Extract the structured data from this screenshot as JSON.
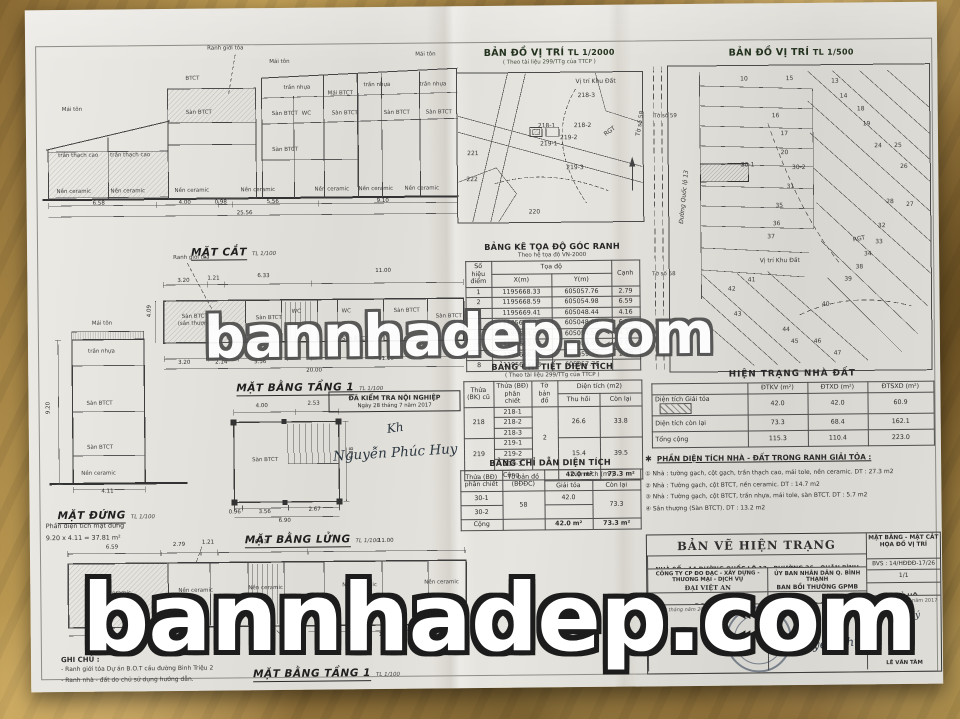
{
  "watermarks": {
    "center": "bannhadep.com",
    "bottom": "bannhadep.com"
  },
  "drawings": {
    "mat_cat": {
      "title": "MẶT CẮT",
      "scale": "TL 1/100",
      "ranh": "Ranh giới tỏa",
      "labels": [
        {
          "t": "Mái tôn",
          "px": 230,
          "py": 12
        },
        {
          "t": "Mái tôn",
          "px": 376,
          "py": 6
        },
        {
          "t": "Mái tôn",
          "px": 22,
          "py": 58
        },
        {
          "t": "BTCT",
          "px": 146,
          "py": 28
        },
        {
          "t": "trần nhựa",
          "px": 244,
          "py": 38
        },
        {
          "t": "trần nhựa",
          "px": 324,
          "py": 36
        },
        {
          "t": "trần nhựa",
          "px": 380,
          "py": 36
        },
        {
          "t": "Sàn BTCT",
          "px": 146,
          "py": 62
        },
        {
          "t": "Sàn BTCT",
          "px": 232,
          "py": 64
        },
        {
          "t": "WC",
          "px": 262,
          "py": 64
        },
        {
          "t": "Sàn BTCT",
          "px": 292,
          "py": 64
        },
        {
          "t": "Sàn BTCT",
          "px": 344,
          "py": 64
        },
        {
          "t": "Sàn BTCT",
          "px": 386,
          "py": 64
        },
        {
          "t": "Mái BTCT",
          "px": 288,
          "py": 44
        },
        {
          "t": "Sàn BTCT",
          "px": 232,
          "py": 100
        },
        {
          "t": "trần thạch cao",
          "px": 18,
          "py": 104
        },
        {
          "t": "trần thạch cao",
          "px": 70,
          "py": 104
        },
        {
          "t": "Nền ceramic",
          "px": 16,
          "py": 140
        },
        {
          "t": "Nền ceramic",
          "px": 70,
          "py": 140
        },
        {
          "t": "Nền ceramic",
          "px": 134,
          "py": 140
        },
        {
          "t": "Nền ceramic",
          "px": 200,
          "py": 140
        },
        {
          "t": "Nền ceramic",
          "px": 274,
          "py": 140
        },
        {
          "t": "Nền ceramic",
          "px": 318,
          "py": 140
        },
        {
          "t": "Nền ceramic",
          "px": 364,
          "py": 140
        }
      ],
      "dims": [
        {
          "t": "6.58",
          "px": 52,
          "py": 152
        },
        {
          "t": "4.00",
          "px": 138,
          "py": 152
        },
        {
          "t": "0.98",
          "px": 174,
          "py": 152
        },
        {
          "t": "5.56",
          "px": 226,
          "py": 152
        },
        {
          "t": "9.10",
          "px": 336,
          "py": 152
        },
        {
          "t": "25.56",
          "px": 196,
          "py": 163
        }
      ]
    },
    "mat_bang_mid": {
      "title": "MẶT BẰNG TẦNG 1",
      "scale": "TL 1/100",
      "ranh": "Ranh giới tỏa",
      "labels": [
        {
          "t": "Sàn BTCT",
          "px": 96,
          "py": 60
        },
        {
          "t": "(sân thượng)",
          "px": 92,
          "py": 67
        },
        {
          "t": "Sàn BTCT",
          "px": 170,
          "py": 62
        },
        {
          "t": "WC",
          "px": 206,
          "py": 56
        },
        {
          "t": "WC",
          "px": 256,
          "py": 56
        },
        {
          "t": "Sàn BTCT",
          "px": 308,
          "py": 56
        },
        {
          "t": "Sàn BTCT",
          "px": 350,
          "py": 62
        },
        {
          "t": "Sàn BTCT",
          "px": 256,
          "py": 84
        }
      ],
      "dims": [
        {
          "t": "3.20",
          "px": 92,
          "py": 24
        },
        {
          "t": "1.21",
          "px": 122,
          "py": 22
        },
        {
          "t": "6.33",
          "px": 172,
          "py": 20
        },
        {
          "t": "11.00",
          "px": 290,
          "py": 16
        },
        {
          "t": "4.09",
          "px": 62,
          "py": 62,
          "r": -90
        },
        {
          "t": "3.20",
          "px": 92,
          "py": 106
        },
        {
          "t": "2.14",
          "px": 129,
          "py": 106
        },
        {
          "t": "3.56",
          "px": 168,
          "py": 106
        },
        {
          "t": "11.10",
          "px": 292,
          "py": 104
        },
        {
          "t": "20.00",
          "px": 220,
          "py": 115
        }
      ]
    },
    "mat_dung": {
      "title": "MẶT ĐỨNG",
      "scale": "TL 1/100",
      "caption1": "Phần diện tích mặt đứng",
      "caption2": "9.20 x 4.11 = 37.81 m²",
      "labels": [
        {
          "t": "Mái tôn",
          "px": 50,
          "py": 0
        },
        {
          "t": "trần nhựa",
          "px": 46,
          "py": 28
        },
        {
          "t": "Sàn BTCT",
          "px": 44,
          "py": 80
        },
        {
          "t": "Sàn BTCT",
          "px": 44,
          "py": 124
        },
        {
          "t": "Nền ceramic",
          "px": 38,
          "py": 150
        }
      ],
      "dims": [
        {
          "t": "9.20",
          "px": 4,
          "py": 92,
          "r": -90
        },
        {
          "t": "4.11",
          "px": 58,
          "py": 168
        }
      ]
    },
    "mat_bang_lung": {
      "title": "MẶT BẰNG LỬNG",
      "scale": "TL 1/100",
      "labels": [
        {
          "t": "Sàn BTCT",
          "px": 28,
          "py": 60
        }
      ],
      "dims": [
        {
          "t": "4.00",
          "px": 32,
          "py": 6
        },
        {
          "t": "2.53",
          "px": 84,
          "py": 4
        },
        {
          "t": "4.38",
          "px": 126,
          "py": 62,
          "r": -90
        },
        {
          "t": "0.96",
          "px": 4,
          "py": 112
        },
        {
          "t": "3.56",
          "px": 34,
          "py": 112
        },
        {
          "t": "2.67",
          "px": 84,
          "py": 110
        },
        {
          "t": "6.90",
          "px": 54,
          "py": 121
        }
      ]
    },
    "mat_bang_bot": {
      "title": "MẶT BẰNG TẦNG 1",
      "scale": "TL 1/100",
      "labels": [
        {
          "t": "Nền ceramic",
          "px": 34,
          "py": 50
        },
        {
          "t": "Nền ceramic",
          "px": 116,
          "py": 48
        },
        {
          "t": "Nền ceramic",
          "px": 186,
          "py": 46
        },
        {
          "t": "Nền ceramic",
          "px": 280,
          "py": 44
        },
        {
          "t": "Nền ceramic",
          "px": 362,
          "py": 42
        }
      ],
      "dims": [
        {
          "t": "6.59",
          "px": 44,
          "py": 4
        },
        {
          "t": "2.79",
          "px": 111,
          "py": 2
        },
        {
          "t": "1.21",
          "px": 140,
          "py": 0
        },
        {
          "t": "6.33",
          "px": 193,
          "py": 0
        },
        {
          "t": "11.00",
          "px": 316,
          "py": 0
        },
        {
          "t": "6.58",
          "px": 44,
          "py": 96
        },
        {
          "t": "11.10",
          "px": 316,
          "py": 94
        }
      ]
    }
  },
  "stamp_check": {
    "line1": "ĐÃ KIỂM TRA NỘI NGHIỆP",
    "line2": "Ngày 28 tháng 7 năm 2017",
    "sign": "Nguyễn Phúc Huy",
    "initial": "Kh"
  },
  "maps": {
    "m2000": {
      "title": "BẢN ĐỒ VỊ TRÍ",
      "scale": "TL 1/2000",
      "subtitle": "( Theo tài liệu 299/TTg của TTCP )",
      "parcels": [
        {
          "t": "Vị trí Khu Đất",
          "px": 120,
          "py": 8
        },
        {
          "t": "218-3",
          "px": 122,
          "py": 22
        },
        {
          "t": "218-1",
          "px": 82,
          "py": 52
        },
        {
          "t": "218-2",
          "px": 118,
          "py": 52
        },
        {
          "t": "219-1",
          "px": 84,
          "py": 70
        },
        {
          "t": "219-2",
          "px": 104,
          "py": 64
        },
        {
          "t": "219-3",
          "px": 110,
          "py": 94
        },
        {
          "t": "220",
          "px": 72,
          "py": 138
        },
        {
          "t": "221",
          "px": 11,
          "py": 79
        },
        {
          "t": "222",
          "px": 10,
          "py": 105
        },
        {
          "t": "RGT",
          "px": 148,
          "py": 58,
          "r": -35
        },
        {
          "t": "Tờ số 58",
          "px": 172,
          "py": 50,
          "r": -80
        }
      ]
    },
    "m500": {
      "title": "BẢN ĐỒ VỊ TRÍ",
      "scale": "TL 1/500",
      "road": "Đường Quốc lộ 13",
      "toso59": "Tờ số 59",
      "toso58": "Tờ số 58",
      "parcels": [
        {
          "t": "10",
          "px": 34,
          "py": 5
        },
        {
          "t": "15",
          "px": 50,
          "py": 5
        },
        {
          "t": "13",
          "px": 66,
          "py": 6
        },
        {
          "t": "14",
          "px": 69,
          "py": 11
        },
        {
          "t": "18",
          "px": 75,
          "py": 15
        },
        {
          "t": "16",
          "px": 45,
          "py": 17
        },
        {
          "t": "17",
          "px": 48,
          "py": 23
        },
        {
          "t": "19",
          "px": 77,
          "py": 20
        },
        {
          "t": "20",
          "px": 48,
          "py": 29
        },
        {
          "t": "24",
          "px": 81,
          "py": 27
        },
        {
          "t": "25",
          "px": 88,
          "py": 27
        },
        {
          "t": "30-1",
          "px": 35,
          "py": 33
        },
        {
          "t": "30-2",
          "px": 53,
          "py": 34
        },
        {
          "t": "26",
          "px": 90,
          "py": 34
        },
        {
          "t": "31",
          "px": 50,
          "py": 40
        },
        {
          "t": "35",
          "px": 46,
          "py": 46
        },
        {
          "t": "28",
          "px": 85,
          "py": 45
        },
        {
          "t": "27",
          "px": 92,
          "py": 46
        },
        {
          "t": "36",
          "px": 45,
          "py": 52
        },
        {
          "t": "32",
          "px": 82,
          "py": 53
        },
        {
          "t": "37",
          "px": 43,
          "py": 56
        },
        {
          "t": "33",
          "px": 81,
          "py": 58
        },
        {
          "t": "34",
          "px": 77,
          "py": 62
        },
        {
          "t": "38",
          "px": 74,
          "py": 66
        },
        {
          "t": "39",
          "px": 70,
          "py": 70
        },
        {
          "t": "40",
          "px": 62,
          "py": 78
        },
        {
          "t": "41",
          "px": 36,
          "py": 70
        },
        {
          "t": "42",
          "px": 29,
          "py": 73
        },
        {
          "t": "43",
          "px": 31,
          "py": 81
        },
        {
          "t": "44",
          "px": 48,
          "py": 86
        },
        {
          "t": "45",
          "px": 51,
          "py": 90
        },
        {
          "t": "46",
          "px": 59,
          "py": 90
        },
        {
          "t": "47",
          "px": 66,
          "py": 94
        },
        {
          "t": "Vị trí Khu Đất",
          "px": 46,
          "py": 64
        },
        {
          "t": "RGT",
          "px": 72,
          "py": 56,
          "r": -10
        }
      ]
    }
  },
  "toado": {
    "title": "BẢNG KÊ TỌA ĐỘ GÓC RANH",
    "subtitle": "Theo hệ tọa độ VN-2000",
    "h": {
      "stt": "Số hiệu điểm",
      "td": "Tọa độ",
      "x": "X(m)",
      "y": "Y(m)",
      "canh": "Cạnh"
    },
    "rows": [
      {
        "p": "1",
        "x": "1195668.33",
        "y": "605057.76",
        "c": "2.79"
      },
      {
        "p": "2",
        "x": "1195668.59",
        "y": "605054.98",
        "c": "6.59"
      },
      {
        "p": "3",
        "x": "1195669.41",
        "y": "605048.44",
        "c": "4.16"
      },
      {
        "p": "4",
        "x": "1195665.27",
        "y": "605048.00",
        "c": "6.58"
      },
      {
        "p": "5",
        "x": "1195664.50",
        "y": "605054.54",
        "c": "4.34"
      },
      {
        "p": "6",
        "x": "1195663.98",
        "y": "605058.85",
        "c": "2.00"
      },
      {
        "p": "7",
        "x": "1195666.01",
        "y": "605059.30",
        "c": "2.48"
      },
      {
        "p": "8",
        "x": "1195668.33",
        "y": "605057.76",
        "c": ""
      }
    ]
  },
  "chitiet": {
    "title": "BẢNG CHI TIẾT DIỆN TÍCH",
    "subtitle": "( Theo tài liệu 299/TTg của TTCP )",
    "h": {
      "cu": "Thửa (BK) cũ",
      "pc": "Thửa (BĐ) phân chiết",
      "to": "Tờ bản đồ",
      "dt": "Diện tích (m2)",
      "th": "Thu hồi",
      "cl": "Còn lại"
    },
    "g1": {
      "cu": "218",
      "r1": "218-1",
      "r2": "218-2",
      "r3": "218-3",
      "th": "26.6",
      "cl": "33.8"
    },
    "g2": {
      "cu": "219",
      "r1": "219-1",
      "r2": "219-2",
      "r3": "219-3",
      "th": "15.4",
      "cl": "39.5"
    },
    "to": "2",
    "cong": "Cộng",
    "cong_th": "42.0 m²",
    "cong_cl": "73.3 m²"
  },
  "chidan": {
    "title": "BẢNG CHỈ DẪN DIỆN TÍCH",
    "h": {
      "pc": "Thửa (BĐ) phân chiết",
      "to": "Tờ bản đồ (BĐĐC)",
      "dt": "Diện tích (m²)",
      "gt": "Giải tỏa",
      "cl": "Còn lại"
    },
    "r1": {
      "pc": "30-1",
      "gt": "42.0"
    },
    "r2": {
      "pc": "30-2",
      "cl": "73.3"
    },
    "to": "58",
    "cong": "Cộng",
    "cong_gt": "42.0 m²",
    "cong_cl": "73.3 m²"
  },
  "hientrang": {
    "title": "HIỆN TRẠNG NHÀ ĐẤT",
    "cols": [
      "ĐTKV (m²)",
      "ĐTXD (m²)",
      "ĐTSXD (m²)"
    ],
    "rows": [
      {
        "label": "Diện tích Giải tỏa",
        "v": [
          "42.0",
          "42.0",
          "60.9"
        ]
      },
      {
        "label": "Diện tích còn lại",
        "v": [
          "73.3",
          "68.4",
          "162.1"
        ]
      },
      {
        "label": "Tổng cộng",
        "v": [
          "115.3",
          "110.4",
          "223.0"
        ]
      }
    ]
  },
  "phan_dt": {
    "star": "✱",
    "title": "PHẦN DIỆN TÍCH NHÀ - ĐẤT TRONG RANH GIẢI TỎA :",
    "items": [
      "① Nhà : tường gạch, cột gạch, trần thạch cao, mái tole, nền ceramic. DT : 27.3 m2",
      "② Nhà : Tường gạch, cột BTCT, nền ceramic. DT : 14.7 m2",
      "③ Nhà : Tường gạch, cột BTCT, trần nhựa, mái tole, sàn BTCT. DT : 5.7 m2",
      "④ Sân thượng (Sàn BTCT). DT : 13.2 m2"
    ]
  },
  "title_block": {
    "title": "BẢN VẼ HIỆN TRẠNG",
    "address": "NHÀ SỐ : 14 ĐƯỜNG QUỐC LỘ 13 - PHƯỜNG 26 - QUẬN BÌNH THẠNH",
    "company1": "CÔNG TY CP ĐO ĐẠC - XÂY DỰNG - THƯƠNG MẠI - DỊCH VỤ",
    "company2": "ĐẠI VIỆT AN",
    "agency1": "ỦY BAN NHÂN DÂN Q. BÌNH THẠNH",
    "agency2": "BAN BỒI THƯỜNG GPMB",
    "sheet_type1": "MẶT BẰNG - MẶT CẮT",
    "sheet_type2": "HỌA ĐỒ VỊ TRÍ",
    "bvs": "BVS : 14/HĐĐĐ-17/26",
    "page": "1/1",
    "role1": "ĐO - VẼ",
    "role2": "TRƯỞNG BAN TĐ",
    "role3": "CHỦ HỘ",
    "date_left": "ngày      tháng      năm 20",
    "date_right": "năm 2017",
    "agree": "Đồng ý",
    "sign_center": "Nguyễn Thị Hường",
    "sign_right": "LÊ VĂN TÂM"
  },
  "ghi_chu": {
    "title": "GHI CHÚ :",
    "items": [
      "- Ranh giới tỏa Dự án B.O.T cầu đường Bình Triệu 2",
      "- Ranh nhà - đất do chủ sử dụng hướng dẫn."
    ]
  }
}
